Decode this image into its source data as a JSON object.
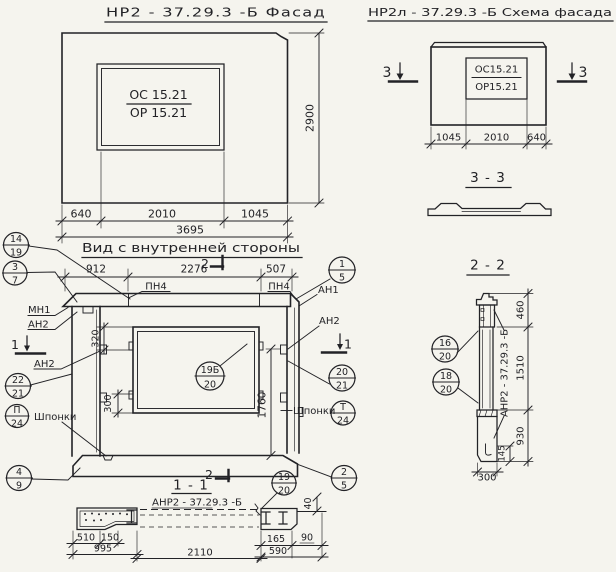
{
  "palette": {
    "paper": "#f5f4ee",
    "ink": "#222226"
  },
  "facade": {
    "title": "НР2 - 37.29.3 -Б   Фасад",
    "window": {
      "top": "ОС 15.21",
      "bottom": "ОР 15.21"
    },
    "dims": {
      "height": "2900",
      "left": "640",
      "middle": "2010",
      "right": "1045",
      "total": "3695"
    }
  },
  "schema": {
    "title": "НР2л - 37.29.3  -Б  Схема фасада",
    "window": {
      "top": "ОС15.21",
      "bottom": "ОР15.21"
    },
    "dims": {
      "left": "1045",
      "middle": "2010",
      "right": "640"
    },
    "marker_left": "3",
    "marker_right": "3"
  },
  "section33": {
    "title": "3 - 3"
  },
  "inner": {
    "title": "Вид с внутренней стороны",
    "marker_top": "2",
    "marker_left": "1",
    "marker_right": "1",
    "dims": {
      "d912": "912",
      "d2276": "2276",
      "d507": "507",
      "d320": "320",
      "d300": "300",
      "d1760": "1760",
      "d40": "40"
    },
    "labels": {
      "pn4_left": "ПН4",
      "pn4_right": "ПН4",
      "mn1": "МН1",
      "an2_a": "АН2",
      "an2_b": "АН2",
      "an2_c": "АН2",
      "an1": "АН1",
      "shponki_left": "Шпонки",
      "shponki_right": "Шпонки"
    }
  },
  "section11": {
    "marker": "2",
    "title": "1 - 1",
    "label": "АНР2 - 37.29.3  -Б",
    "dims": {
      "d510": "510",
      "d150": "150",
      "d995": "995",
      "d2110": "2110",
      "d165": "165",
      "d90": "90",
      "d590": "590"
    }
  },
  "section22": {
    "title": "2 - 2",
    "label": "АНР2 - 37.29.3 -Б",
    "dims": {
      "d460": "460",
      "d1510": "1510",
      "d930": "930",
      "d145": "145",
      "d300": "300"
    }
  },
  "callouts": {
    "c14_19": {
      "top": "14",
      "bot": "19"
    },
    "c3_7": {
      "top": "3",
      "bot": "7"
    },
    "c22_21": {
      "top": "22",
      "bot": "21"
    },
    "cP_24": {
      "top": "П",
      "bot": "24"
    },
    "c4_9": {
      "top": "4",
      "bot": "9"
    },
    "c1_5": {
      "top": "1",
      "bot": "5"
    },
    "c20_21": {
      "top": "20",
      "bot": "21"
    },
    "cT_24": {
      "top": "Т",
      "bot": "24"
    },
    "c2_5": {
      "top": "2",
      "bot": "5"
    },
    "c19_20": {
      "top": "19",
      "bot": "20"
    },
    "c19b_20": {
      "top": "19Б",
      "bot": "20"
    },
    "c16_20": {
      "top": "16",
      "bot": "20"
    },
    "c18_20": {
      "top": "18",
      "bot": "20"
    }
  }
}
